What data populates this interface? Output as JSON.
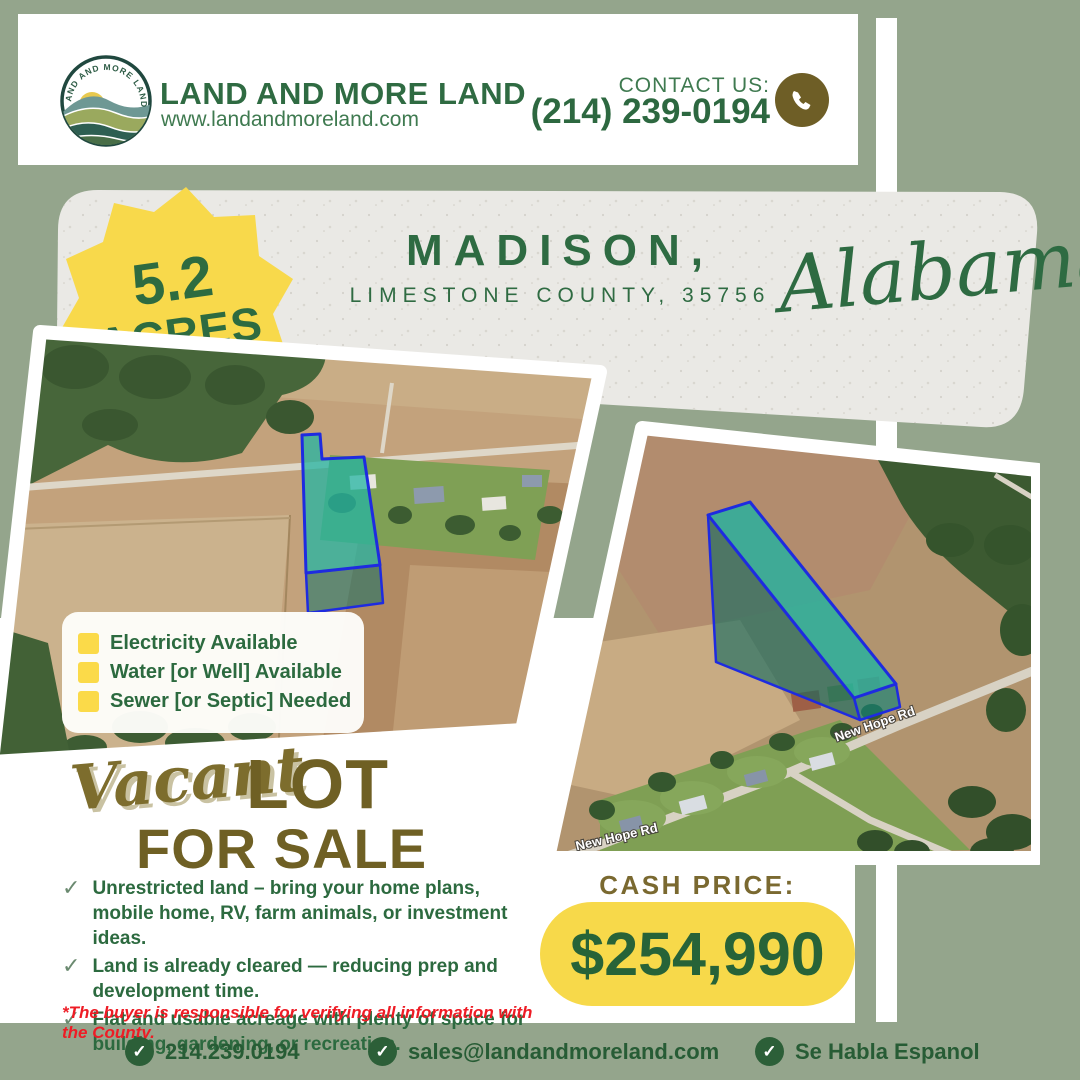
{
  "colors": {
    "sage_background": "#94a58c",
    "dark_green": "#2e6b42",
    "olive_gold": "#6f6024",
    "accent_yellow": "#f7d94a",
    "paper_gray": "#eae9e5",
    "alert_red": "#ee1c25",
    "parcel_teal": "#24b4a3",
    "parcel_outline_blue": "#1e2be0"
  },
  "header": {
    "logo_arc_text": "LAND AND MORE LAND",
    "brand": "LAND AND MORE LAND",
    "website": "www.landandmoreland.com",
    "contact_label": "CONTACT US:",
    "phone": "(214) 239-0194"
  },
  "badge": {
    "acreage": "5.2",
    "unit": "ACRES"
  },
  "location": {
    "city": "MADISON,",
    "county_zip": "LIMESTONE COUNTY, 35756",
    "state": "Alabama"
  },
  "map": {
    "road_label": "New Hope Rd"
  },
  "features": [
    "Electricity Available",
    "Water [or Well] Available",
    "Sewer [or Septic] Needed"
  ],
  "sale": {
    "script": "Vacant",
    "word1": "LOT",
    "word2": "FOR SALE"
  },
  "bullets": [
    "Unrestricted land – bring your home plans, mobile home, RV, farm animals, or investment ideas.",
    "Land is already cleared — reducing prep and development time.",
    "Flat and usable acreage with plenty of space for building, gardening, or recreation."
  ],
  "disclaimer": "*The buyer is responsible for verifying all information with the County.",
  "price": {
    "label": "CASH PRICE:",
    "amount": "$254,990"
  },
  "footer": {
    "phone": "214.239.0194",
    "email": "sales@landandmoreland.com",
    "language": "Se Habla Espanol"
  }
}
